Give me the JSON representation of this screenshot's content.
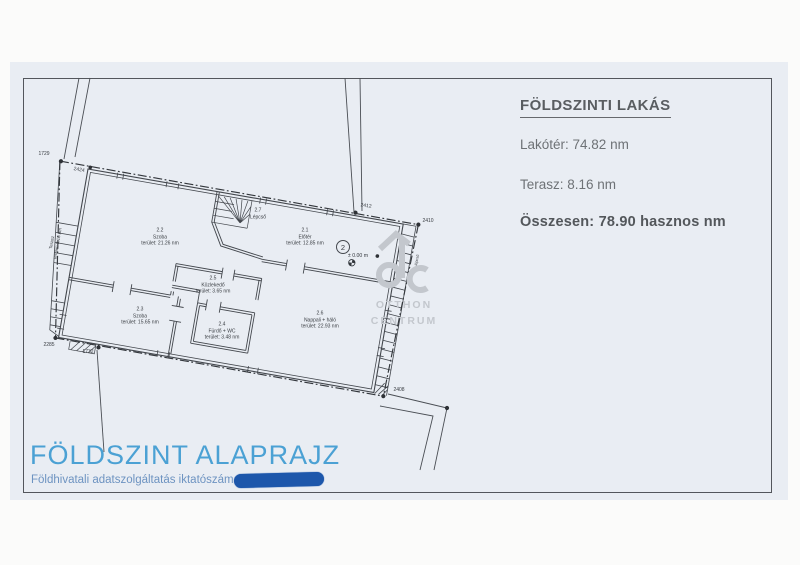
{
  "document": {
    "info_panel": {
      "title": "FÖLDSZINTI LAKÁS",
      "living_area": "Lakótér: 74.82 nm",
      "terrace": "Terasz: 8.16 nm",
      "total": "Összesen: 78.90 hasznos nm"
    },
    "footer": {
      "title": "FÖLDSZINT ALAPRAJZ",
      "registry_label": "Földhivatali adatszolgáltatás iktatószáma:"
    },
    "watermark": {
      "line1": "OTTHON",
      "line2": "CENTRUM"
    }
  },
  "plan": {
    "rooms": [
      {
        "id": "2.1",
        "name": "Előtér",
        "area": "terület: 12.85 nm"
      },
      {
        "id": "2.2",
        "name": "Szoba",
        "area": "terület: 21.26 nm"
      },
      {
        "id": "2.3",
        "name": "Szoba",
        "area": "terület: 15.65 nm"
      },
      {
        "id": "2.4",
        "name": "Fürdő + WC",
        "area": "terület: 3.48 nm"
      },
      {
        "id": "2.5",
        "name": "Közlekedő",
        "area": "terület: 3.65 nm"
      },
      {
        "id": "2.6",
        "name": "Nappali + háló",
        "area": "terület: 22.93 nm"
      },
      {
        "id": "2.7",
        "name": "Lépcső",
        "area": ""
      }
    ],
    "terrace_label": {
      "name": "Terasz",
      "area": "terület: 8.16 nm"
    },
    "side_stair_label": "lépcső",
    "level_marker": "± 0.00 m",
    "position_marker": "2",
    "survey_points": {
      "p1729": "1729",
      "p2424": "2424",
      "p2412": "2412",
      "p2410": "2410",
      "p2408": "2408",
      "p2285": "2285",
      "p1732": "1732"
    }
  },
  "colors": {
    "accent_blue": "#4ba1d4",
    "redaction_blue": "#1d57ab",
    "watermark_gray": "#c3c7cd",
    "scan_background": "#e9edf3"
  }
}
